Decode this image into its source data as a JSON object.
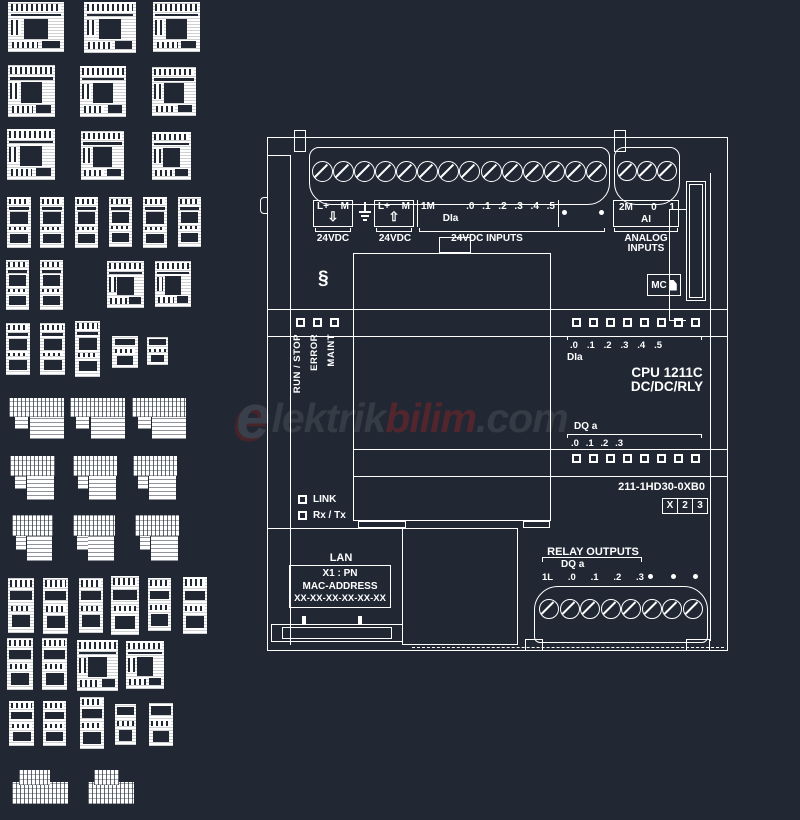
{
  "page": {
    "background": "#212834",
    "line_color": "#ffffff"
  },
  "watermark": {
    "logo_letter": "e",
    "text_gray": "lektrik",
    "text_red": "bilim",
    "text_suffix": ".com",
    "gray": "#363c46",
    "red": "#53262e"
  },
  "main": {
    "power_in": {
      "pos": "L+",
      "neg": "M",
      "arrow": "⇩",
      "caption": "24VDC"
    },
    "sensor_out": {
      "pos": "L+",
      "neg": "M",
      "arrow": "⇧",
      "caption": "24VDC"
    },
    "di_top": {
      "common": "1M",
      "channels": [
        ".0",
        ".1",
        ".2",
        ".3",
        ".4",
        ".5"
      ],
      "group": "DIa",
      "caption": "24VDC INPUTS",
      "unused_dots": 2
    },
    "ai_top": {
      "common": "2M",
      "channels": [
        "0",
        "1"
      ],
      "group": "AI",
      "caption_line1": "ANALOG",
      "caption_line2": "INPUTS"
    },
    "screw_count_main": 14,
    "screw_count_analog": 3,
    "section_symbol": "§",
    "status_labels": [
      "RUN / STOP",
      "ERROR",
      "MAINT"
    ],
    "status_led_count": 3,
    "mc_label": "MC",
    "di_block": {
      "led_count": 8,
      "channels": [
        ".0",
        ".1",
        ".2",
        ".3",
        ".4",
        ".5"
      ],
      "group": "DIa"
    },
    "cpu_line1": "CPU 1211C",
    "cpu_line2": "DC/DC/RLY",
    "dq_block": {
      "group": "DQ a",
      "channels": [
        ".0",
        ".1",
        ".2",
        ".3"
      ],
      "led_count": 8
    },
    "order_number": "211-1HD30-0XB0",
    "version_boxes": [
      "X",
      "2",
      "3"
    ],
    "link_label": "LINK",
    "rx_label": "Rx / Tx",
    "lan": {
      "title": "LAN",
      "line1": "X1 : PN",
      "line2": "MAC-ADDRESS",
      "line3": "XX-XX-XX-XX-XX-XX"
    },
    "relay": {
      "title": "RELAY OUTPUTS",
      "group": "DQ a",
      "channels": [
        "1L",
        ".0",
        ".1",
        ".2",
        ".3"
      ],
      "unused_dots": 3,
      "screw_count": 8
    }
  },
  "thumbnails": {
    "items": [
      [
        8,
        2,
        56,
        50,
        "front"
      ],
      [
        84,
        2,
        52,
        51,
        "front"
      ],
      [
        153,
        2,
        47,
        50,
        "front"
      ],
      [
        8,
        65,
        47,
        52,
        "front"
      ],
      [
        80,
        66,
        46,
        51,
        "front"
      ],
      [
        152,
        67,
        44,
        49,
        "front"
      ],
      [
        7,
        129,
        48,
        51,
        "front"
      ],
      [
        81,
        131,
        43,
        49,
        "front"
      ],
      [
        152,
        132,
        39,
        48,
        "front"
      ],
      [
        7,
        197,
        24,
        51,
        "tall"
      ],
      [
        40,
        197,
        24,
        51,
        "tall"
      ],
      [
        75,
        197,
        23,
        51,
        "tall"
      ],
      [
        109,
        197,
        23,
        50,
        "tall"
      ],
      [
        143,
        197,
        24,
        51,
        "tall"
      ],
      [
        178,
        197,
        23,
        50,
        "tall"
      ],
      [
        6,
        260,
        23,
        50,
        "tall"
      ],
      [
        40,
        260,
        23,
        50,
        "tall"
      ],
      [
        107,
        261,
        37,
        47,
        "front"
      ],
      [
        155,
        261,
        36,
        46,
        "front"
      ],
      [
        6,
        323,
        24,
        52,
        "tall"
      ],
      [
        40,
        323,
        25,
        52,
        "tall"
      ],
      [
        75,
        321,
        25,
        56,
        "tall"
      ],
      [
        112,
        336,
        26,
        32,
        "mini"
      ],
      [
        147,
        337,
        21,
        28,
        "mini"
      ],
      [
        9,
        397,
        57,
        43,
        "angled"
      ],
      [
        70,
        397,
        57,
        43,
        "angled"
      ],
      [
        132,
        397,
        56,
        43,
        "angled"
      ],
      [
        10,
        455,
        46,
        46,
        "angled"
      ],
      [
        73,
        455,
        45,
        46,
        "angled"
      ],
      [
        133,
        455,
        45,
        46,
        "angled"
      ],
      [
        12,
        514,
        42,
        48,
        "angled"
      ],
      [
        73,
        514,
        43,
        48,
        "angled"
      ],
      [
        135,
        514,
        45,
        48,
        "angled"
      ],
      [
        8,
        578,
        26,
        55,
        "mini2"
      ],
      [
        43,
        578,
        25,
        56,
        "mini2"
      ],
      [
        79,
        578,
        24,
        55,
        "mini2"
      ],
      [
        111,
        576,
        28,
        59,
        "mini2"
      ],
      [
        148,
        578,
        23,
        53,
        "mini2"
      ],
      [
        183,
        577,
        24,
        57,
        "mini2"
      ],
      [
        7,
        638,
        26,
        52,
        "mini2"
      ],
      [
        42,
        638,
        25,
        52,
        "mini2"
      ],
      [
        77,
        640,
        41,
        51,
        "front"
      ],
      [
        126,
        641,
        38,
        48,
        "front"
      ],
      [
        9,
        701,
        25,
        45,
        "mini2"
      ],
      [
        43,
        701,
        23,
        45,
        "mini2"
      ],
      [
        80,
        697,
        24,
        52,
        "mini2"
      ],
      [
        115,
        704,
        21,
        41,
        "mini"
      ],
      [
        149,
        703,
        24,
        43,
        "mini"
      ],
      [
        12,
        770,
        56,
        36,
        "flat"
      ],
      [
        88,
        770,
        46,
        36,
        "flat"
      ]
    ]
  }
}
